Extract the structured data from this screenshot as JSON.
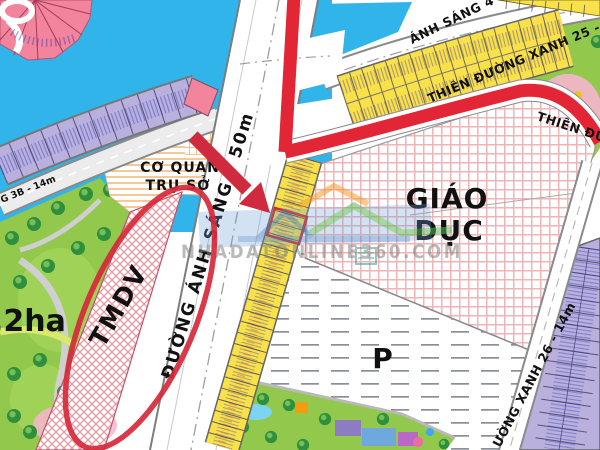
{
  "map": {
    "zones": {
      "co_quan_line1": "CƠ QUAN",
      "co_quan_line2": "TRỤ SỞ",
      "giao_duc_line1": "GIÁO",
      "giao_duc_line2": "DỤC",
      "tmdv": "TMDV",
      "parking": "P",
      "area_label": ",2ha"
    },
    "roads": {
      "main": "ĐƯỜNG ÁNH SÁNG - 50m",
      "anh_sang_4": "ÁNH SÁNG 4 - 20,",
      "anh_sang_3b": "G 3B - 14m",
      "thien_duong_xanh_25": "THIÊN ĐƯỜNG XANH 25 - 14m",
      "thien_duong_xanh_25_cont": "THIÊN ĐƯỜNG",
      "thien_duong_xanh_26": "ƯỜNG XANH 26 - 14m"
    },
    "watermark": "NHADATONLINE360.COM",
    "colors": {
      "water": "#31b4ea",
      "grass": "#92c84c",
      "lot_yellow": "#f8e14b",
      "lot_purple": "#b9b0de",
      "lot_pink": "#f2849e",
      "education_pink": "#f0b3b6",
      "route_red": "#e32636",
      "annotation_red": "#cf2a3e"
    }
  }
}
